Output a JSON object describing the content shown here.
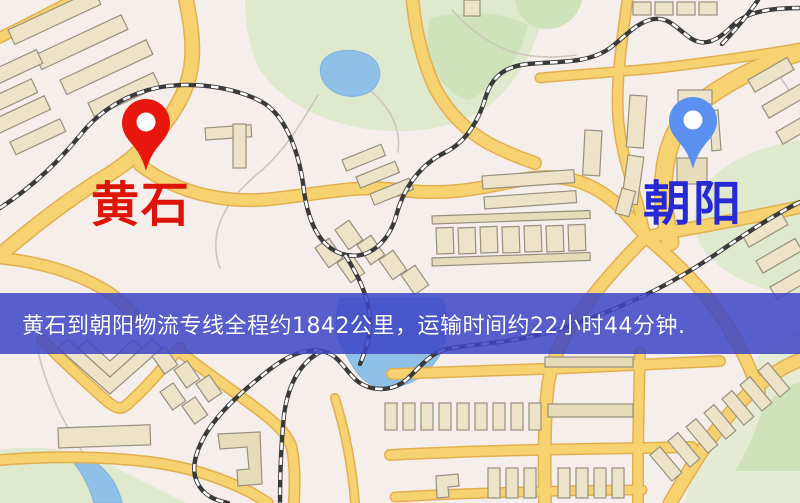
{
  "banner": {
    "text": "黄石到朝阳物流专线全程约1842公里，运输时间约22小时44分钟.",
    "background_color": "rgba(62,70,198,0.86)",
    "text_color": "#ffffff"
  },
  "markers": {
    "origin": {
      "label": "黄石",
      "pin_color": "#e8170d",
      "label_color": "#df1409",
      "icon": "map-pin-icon"
    },
    "destination": {
      "label": "朝阳",
      "pin_color": "#5b90f0",
      "label_color": "#2629d4",
      "icon": "map-pin-icon"
    }
  },
  "map_colors": {
    "background": "#f5eeea",
    "road_fill": "#f6d271",
    "road_casing": "#e2af4f",
    "park": "#dfe9ce",
    "water": "#8fc1e8",
    "building": "#ece3c9",
    "railway": "#3a3a3a"
  }
}
